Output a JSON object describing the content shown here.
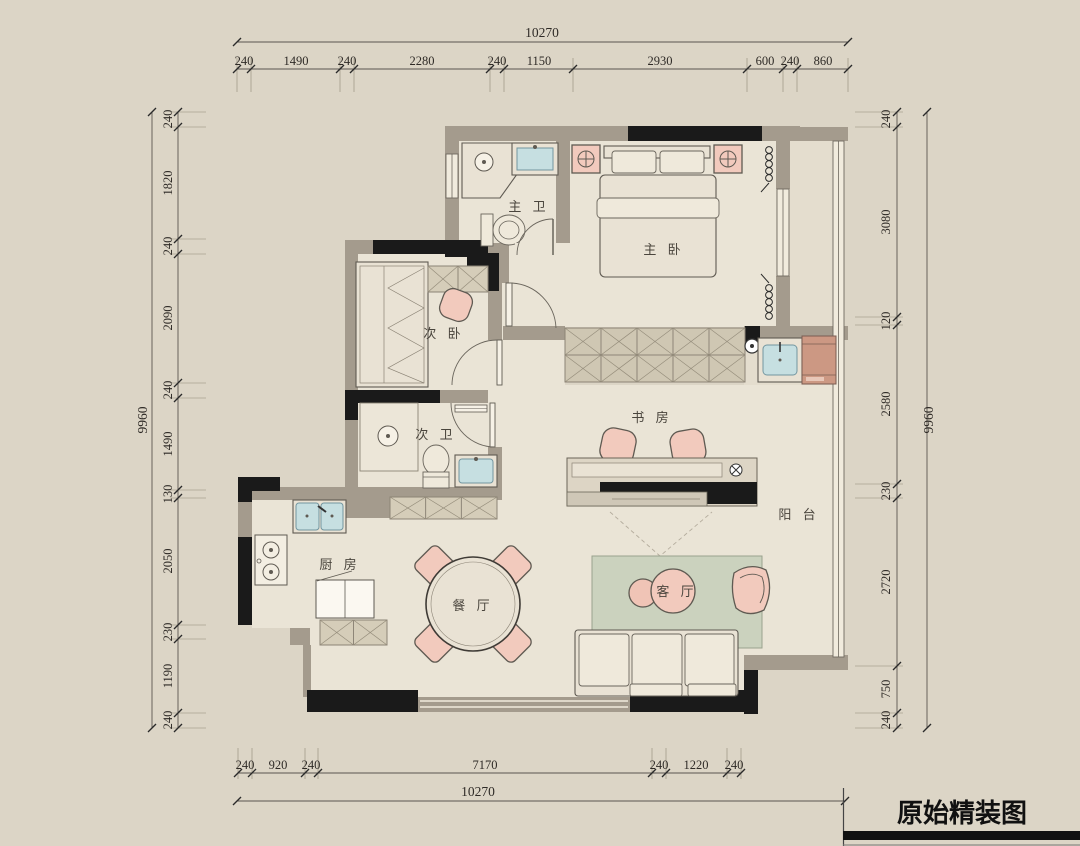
{
  "title": "原始精装图",
  "rooms": {
    "master_bath": "主 卫",
    "master_bedroom": "主 卧",
    "second_bedroom": "次 卧",
    "second_bath": "次 卫",
    "study": "书 房",
    "balcony": "阳 台",
    "kitchen": "厨 房",
    "dining": "餐 厅",
    "living": "客 厅"
  },
  "dims": {
    "top": {
      "total": "10270",
      "segments": [
        "240",
        "1490",
        "240",
        "2280",
        "240",
        "1150",
        "2930",
        "600",
        "240",
        "860"
      ]
    },
    "left": {
      "total": "9960",
      "segments": [
        "240",
        "1820",
        "240",
        "2090",
        "240",
        "1490",
        "130",
        "2050",
        "230",
        "1190",
        "240"
      ]
    },
    "right": {
      "total": "9960",
      "segments": [
        "240",
        "3080",
        "120",
        "2580",
        "230",
        "2720",
        "750",
        "240"
      ]
    },
    "bottom": {
      "total": "10270",
      "segments": [
        "240",
        "920",
        "240",
        "7170",
        "240",
        "1220",
        "240"
      ]
    }
  },
  "colors": {
    "background": "#dcd5c6",
    "floor": "#eae4d6",
    "wall_black": "#1a1a1a",
    "wall_gray": "#a49b8d",
    "furniture_pink": "#f2cabd",
    "fixture_teal": "#c6dfe1",
    "rug_green": "#cbd2be",
    "cabinet_tan": "#d5cdb9",
    "washer_terracotta": "#cc9883"
  }
}
